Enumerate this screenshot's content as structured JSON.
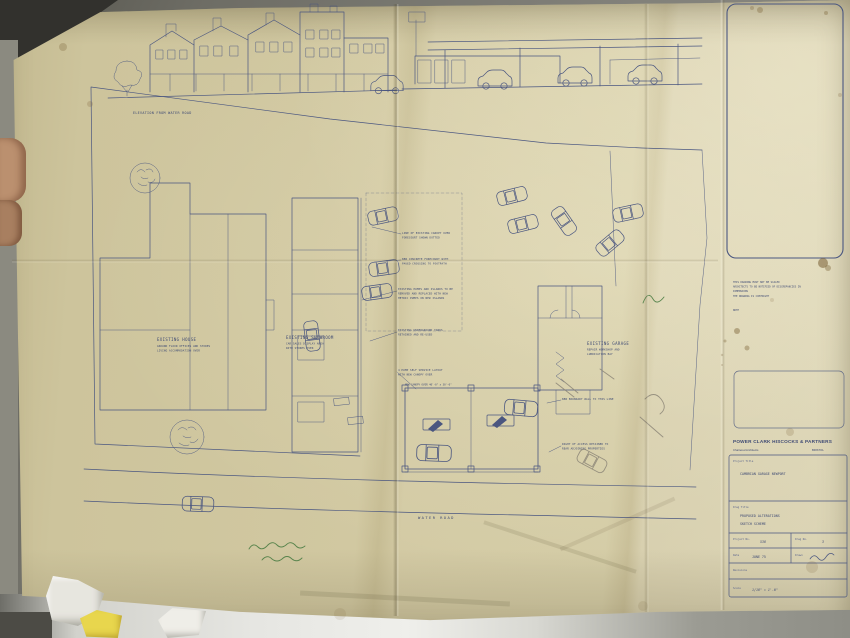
{
  "scene": {
    "paper_color": "#cfc6a2",
    "ink_color": "#4a5680",
    "background_color": "#6e6d65",
    "table_color": "#e6e6e2",
    "scrap_yellow": "#e8d64d"
  },
  "elevation": {
    "label": "ELEVATION FROM WATER ROAD"
  },
  "plan": {
    "existing_house": {
      "title": "EXISTING HOUSE",
      "sub1": "GROUND FLOOR OFFICES AND STORES",
      "sub2": "LIVING ACCOMMODATION OVER"
    },
    "existing_showroom": {
      "title": "EXISTING SHOWROOM",
      "sub1": "CAR SALES DISPLAY AREA",
      "sub2": "WITH STORES OVER"
    },
    "existing_garage": {
      "title": "EXISTING GARAGE",
      "sub1": "REPAIR WORKSHOP AND",
      "sub2": "LUBRICATION BAY"
    },
    "road_label": "WATER ROAD",
    "notes": [
      {
        "lines": [
          "LINE OF EXISTING CANOPY OVER",
          "FORECOURT SHOWN DOTTED"
        ]
      },
      {
        "lines": [
          "NEW CONCRETE FORECOURT WITH",
          "PAVED CROSSING TO FOOTPATH"
        ]
      },
      {
        "lines": [
          "EXISTING PUMPS AND ISLANDS TO BE",
          "REMOVED AND REPLACED WITH NEW",
          "METRIC PUMPS ON NEW ISLANDS"
        ]
      },
      {
        "lines": [
          "EXISTING UNDERGROUND TANKS",
          "RETAINED AND RE-USED"
        ]
      },
      {
        "lines": [
          "4 PUMP SELF SERVICE LAYOUT",
          "WITH NEW CANOPY OVER"
        ]
      },
      {
        "lines": [
          "NEW CANOPY OVER 40'-0\" x 30'-0\""
        ]
      },
      {
        "lines": [
          "NEW BOUNDARY WALL TO THIS LINE"
        ]
      },
      {
        "lines": [
          "RIGHT OF ACCESS RETAINED TO",
          "REAR ADJOINING PROPERTIES"
        ]
      }
    ]
  },
  "side_note": {
    "line1": "THIS DRAWING MUST NOT BE SCALED",
    "line2": "ARCHITECTS TO BE NOTIFIED OF DISCREPANCIES IN",
    "line3": "DIMENSIONS",
    "line4": "THE DRAWING IS COPYRIGHT",
    "footer": "NOTE"
  },
  "title_block": {
    "firm_name": "POWER CLARK HISCOCKS & PARTNERS",
    "firm_left": "Chartered Architects",
    "firm_right": "BRISTOL",
    "project_title_label": "Project Title",
    "project_title": "CAMBRIAN GARAGE   NEWPORT",
    "drawing_title_label": "Drwg Title",
    "drawing_title_line1": "PROPOSED ALTERATIONS",
    "drawing_title_line2": "SKETCH SCHEME",
    "project_no_label": "Project No.",
    "project_no": "536",
    "drawing_no_label": "Drwg No.",
    "drawing_no": "3",
    "date_label": "Date",
    "date": "JUNE 75",
    "drawn_label": "Drawn",
    "revisions_label": "Revisions",
    "scale_label": "Scale",
    "scale": "1/16\" = 1'-0\""
  }
}
